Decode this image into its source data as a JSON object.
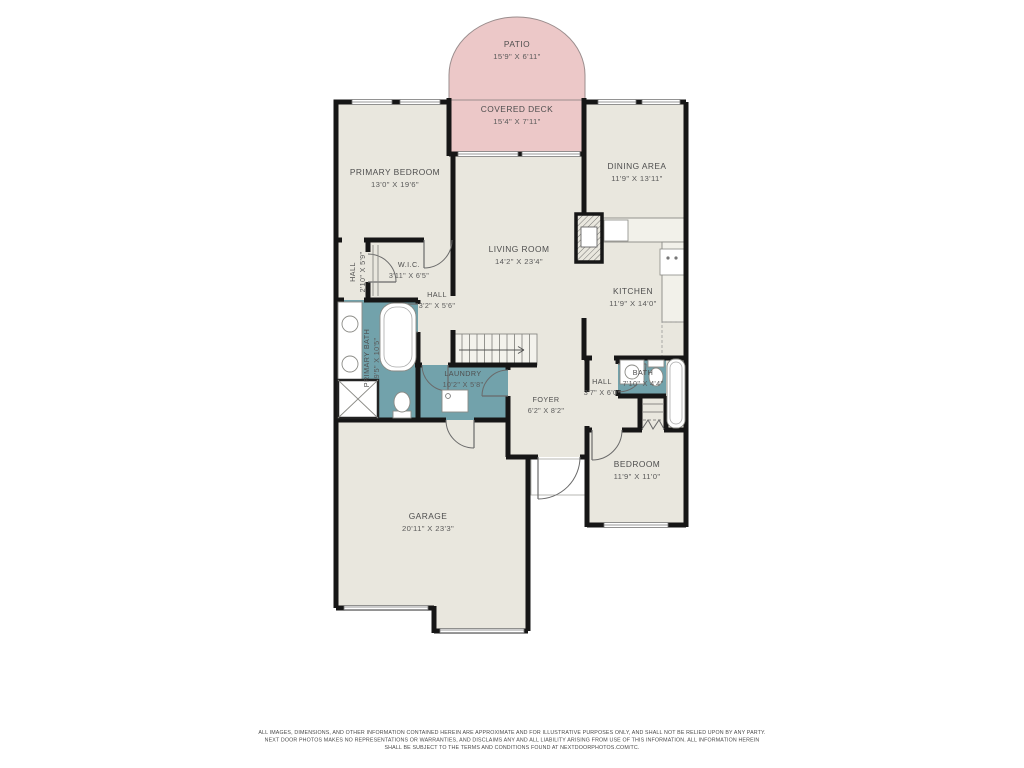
{
  "colors": {
    "wall": "#161616",
    "floor_fill": "#e9e7de",
    "outdoor_fill": "#ecc8c8",
    "wet_room_fill": "#72a2ab",
    "label_text": "#4e4e4e"
  },
  "rooms": {
    "patio": {
      "name": "PATIO",
      "dims": "15'9\" X 6'11\""
    },
    "covered_deck": {
      "name": "COVERED DECK",
      "dims": "15'4\" X 7'11\""
    },
    "primary_bedroom": {
      "name": "PRIMARY BEDROOM",
      "dims": "13'0\" X 19'6\""
    },
    "dining_area": {
      "name": "DINING AREA",
      "dims": "11'9\" X 13'11\""
    },
    "living_room": {
      "name": "LIVING ROOM",
      "dims": "14'2\" X 23'4\""
    },
    "kitchen": {
      "name": "KITCHEN",
      "dims": "11'9\" X 14'0\""
    },
    "hall_left": {
      "name": "HALL",
      "dims": "2'10\" X 5'9\""
    },
    "wic": {
      "name": "W.I.C.",
      "dims": "3'11\" X 6'5\""
    },
    "hall_center": {
      "name": "HALL",
      "dims": "3'2\" X 5'6\""
    },
    "primary_bath": {
      "name": "PRIMARY BATH",
      "dims": "9'5\" X 10'5\""
    },
    "laundry": {
      "name": "LAUNDRY",
      "dims": "10'2\" X 5'8\""
    },
    "foyer": {
      "name": "FOYER",
      "dims": "6'2\" X 8'2\""
    },
    "hall_right": {
      "name": "HALL",
      "dims": "3'7\" X 6'0\""
    },
    "bath": {
      "name": "BATH",
      "dims": "7'10\" X 4'4\""
    },
    "bedroom": {
      "name": "BEDROOM",
      "dims": "11'9\" X 11'0\""
    },
    "garage": {
      "name": "GARAGE",
      "dims": "20'11\" X 23'3\""
    }
  },
  "disclaimer": {
    "line1": "ALL IMAGES, DIMENSIONS, AND OTHER INFORMATION CONTAINED HEREIN ARE APPROXIMATE AND FOR ILLUSTRATIVE PURPOSES ONLY, AND SHALL NOT BE RELIED UPON BY ANY PARTY.",
    "line2": "NEXT DOOR PHOTOS MAKES NO REPRESENTATIONS OR WARRANTIES, AND DISCLAIMS ANY AND ALL LIABILITY ARISING FROM USE OF THIS INFORMATION. ALL INFORMATION HEREIN",
    "line3": "SHALL BE SUBJECT TO THE TERMS AND CONDITIONS FOUND AT NEXTDOORPHOTOS.COM/TC."
  }
}
